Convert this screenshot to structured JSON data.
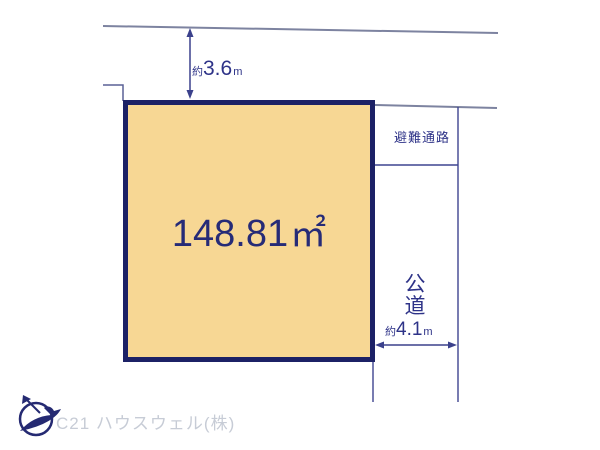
{
  "plot": {
    "area_value": "148.81",
    "area_unit": "㎡",
    "fill_color": "#f7d794",
    "border_color": "#1c2166"
  },
  "dims": {
    "top": {
      "prefix": "約",
      "value": "3.6",
      "unit": "m"
    },
    "right": {
      "prefix": "約",
      "value": "4.1",
      "unit": "m"
    }
  },
  "labels": {
    "evacuation": "避難通路",
    "road": [
      "公",
      "道"
    ]
  },
  "footer": {
    "company": "C21 ハウスウェル(株)"
  },
  "colors": {
    "diagram_navy": "#3b418c",
    "road_line_gray": "#7d83a0",
    "text_navy": "#2e3388",
    "watermark_gray": "#c7ccd6",
    "logo_navy": "#252a72"
  }
}
